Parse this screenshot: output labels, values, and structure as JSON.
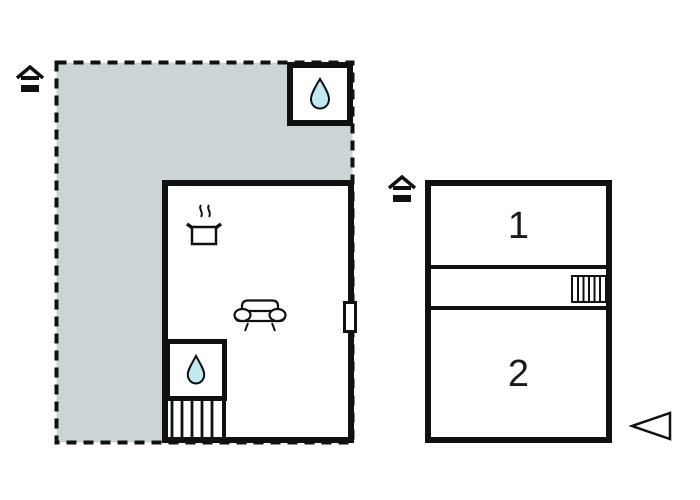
{
  "palette": {
    "line": "#111111",
    "terrace_fill": "#ccd5d5",
    "water_drop_fill": "#bfeaf3",
    "room_fill": "#ffffff"
  },
  "left_unit": {
    "icons": [
      "entrance-house-icon",
      "water-drop-icon",
      "cooking-pot-icon",
      "sofa-icon",
      "water-drop-icon",
      "stairs-icon",
      "window-marker"
    ]
  },
  "right_unit": {
    "rooms": [
      {
        "label": "1"
      },
      {
        "label": "2"
      }
    ],
    "icons": [
      "entrance-house-icon",
      "stairs-icon",
      "direction-arrow-icon"
    ]
  }
}
